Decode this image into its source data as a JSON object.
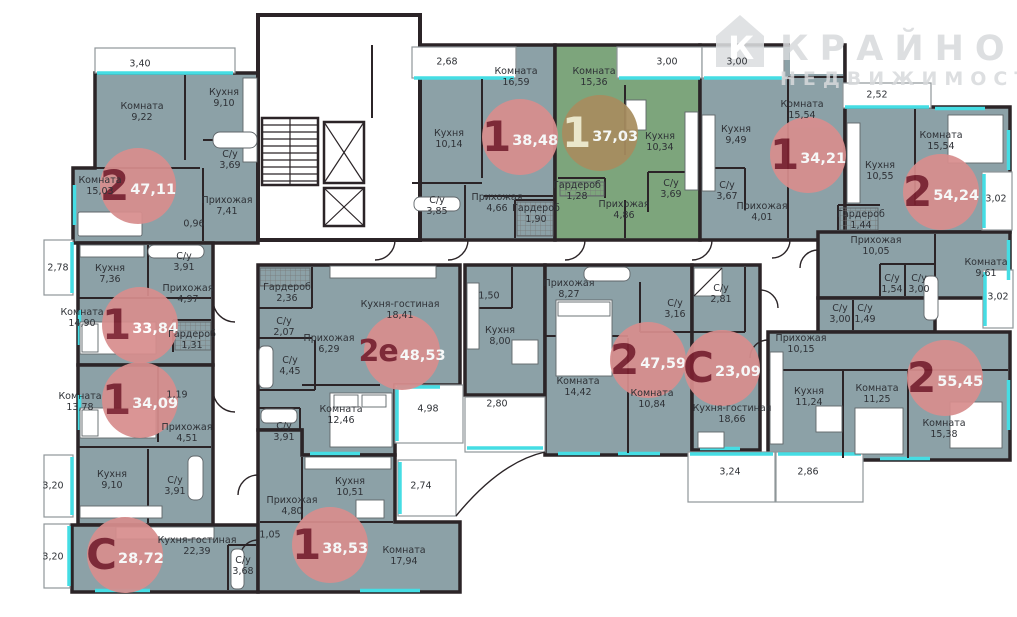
{
  "brand": {
    "line1": "КРАЙНОВ",
    "line2": "НЕДВИЖИМОСТЬ",
    "logo_letter": "К"
  },
  "palette": {
    "aptFill": "#8ca1a7",
    "aptHl": "#7da57c",
    "wall": "#2b2427",
    "accent": "#45dde4",
    "badge": "#d88e8e",
    "badgeType": "#7c2130",
    "badgeHl": "#a78d5f",
    "label": "#2e3136",
    "watermark": "#d8dadc"
  },
  "apartments": [
    {
      "type": "2",
      "area": "47,11",
      "x": 138,
      "y": 186,
      "highlight": false
    },
    {
      "type": "1",
      "area": "33,84",
      "x": 140,
      "y": 325,
      "highlight": false
    },
    {
      "type": "1",
      "area": "34,09",
      "x": 140,
      "y": 400,
      "highlight": false
    },
    {
      "type": "С",
      "area": "28,72",
      "x": 125,
      "y": 555,
      "highlight": false
    },
    {
      "type": "1",
      "area": "38,53",
      "x": 330,
      "y": 545,
      "highlight": false
    },
    {
      "type": "2е",
      "area": "48,53",
      "x": 402,
      "y": 352,
      "highlight": false
    },
    {
      "type": "1",
      "area": "38,48",
      "x": 520,
      "y": 137,
      "highlight": false
    },
    {
      "type": "1",
      "area": "37,03",
      "x": 600,
      "y": 133,
      "highlight": true
    },
    {
      "type": "1",
      "area": "34,21",
      "x": 808,
      "y": 155,
      "highlight": false
    },
    {
      "type": "2",
      "area": "54,24",
      "x": 941,
      "y": 192,
      "highlight": false
    },
    {
      "type": "2",
      "area": "47,59",
      "x": 648,
      "y": 360,
      "highlight": false
    },
    {
      "type": "С",
      "area": "23,09",
      "x": 722,
      "y": 368,
      "highlight": false
    },
    {
      "type": "2",
      "area": "55,45",
      "x": 945,
      "y": 378,
      "highlight": false
    }
  ],
  "rooms": [
    {
      "name": "",
      "area": "3,40",
      "x": 140,
      "y": 64
    },
    {
      "name": "Комната",
      "area": "9,22",
      "x": 142,
      "y": 112
    },
    {
      "name": "Кухня",
      "area": "9,10",
      "x": 224,
      "y": 98
    },
    {
      "name": "Комната",
      "area": "15,03",
      "x": 100,
      "y": 186
    },
    {
      "name": "С/у",
      "area": "3,69",
      "x": 230,
      "y": 160
    },
    {
      "name": "Прихожая",
      "area": "7,41",
      "x": 227,
      "y": 206
    },
    {
      "name": "",
      "area": "0,96",
      "x": 194,
      "y": 224
    },
    {
      "name": "",
      "area": "2,78",
      "x": 58,
      "y": 268
    },
    {
      "name": "Кухня",
      "area": "7,36",
      "x": 110,
      "y": 274
    },
    {
      "name": "С/у",
      "area": "3,91",
      "x": 184,
      "y": 262
    },
    {
      "name": "Прихожая",
      "area": "4,97",
      "x": 188,
      "y": 294
    },
    {
      "name": "Комната",
      "area": "14,90",
      "x": 82,
      "y": 318
    },
    {
      "name": "Гардероб",
      "area": "1,31",
      "x": 192,
      "y": 340
    },
    {
      "name": "Комната",
      "area": "13,78",
      "x": 80,
      "y": 402
    },
    {
      "name": "",
      "area": "1,19",
      "x": 177,
      "y": 395
    },
    {
      "name": "Прихожая",
      "area": "4,51",
      "x": 187,
      "y": 433
    },
    {
      "name": "Кухня",
      "area": "9,10",
      "x": 112,
      "y": 480
    },
    {
      "name": "С/у",
      "area": "3,91",
      "x": 175,
      "y": 486
    },
    {
      "name": "",
      "area": "3,20",
      "x": 53,
      "y": 486
    },
    {
      "name": "",
      "area": "3,20",
      "x": 53,
      "y": 557
    },
    {
      "name": "Кухня-гостиная",
      "area": "22,39",
      "x": 197,
      "y": 546
    },
    {
      "name": "С/у",
      "area": "3,68",
      "x": 243,
      "y": 566
    },
    {
      "name": "Прихожая",
      "area": "4,80",
      "x": 292,
      "y": 506
    },
    {
      "name": "",
      "area": "1,05",
      "x": 270,
      "y": 535
    },
    {
      "name": "Кухня",
      "area": "10,51",
      "x": 350,
      "y": 487
    },
    {
      "name": "",
      "area": "2,74",
      "x": 421,
      "y": 486
    },
    {
      "name": "Комната",
      "area": "17,94",
      "x": 404,
      "y": 556
    },
    {
      "name": "Гардероб",
      "area": "2,36",
      "x": 287,
      "y": 293
    },
    {
      "name": "С/у",
      "area": "2,07",
      "x": 284,
      "y": 327
    },
    {
      "name": "Прихожая",
      "area": "6,29",
      "x": 329,
      "y": 344
    },
    {
      "name": "С/у",
      "area": "4,45",
      "x": 290,
      "y": 366
    },
    {
      "name": "Кухня-гостиная",
      "area": "18,41",
      "x": 400,
      "y": 310
    },
    {
      "name": "Комната",
      "area": "12,46",
      "x": 341,
      "y": 415
    },
    {
      "name": "С/у",
      "area": "3,91",
      "x": 284,
      "y": 432
    },
    {
      "name": "",
      "area": "4,98",
      "x": 428,
      "y": 409
    },
    {
      "name": "",
      "area": "1,50",
      "x": 489,
      "y": 296
    },
    {
      "name": "Кухня",
      "area": "8,00",
      "x": 500,
      "y": 336
    },
    {
      "name": "",
      "area": "2,80",
      "x": 497,
      "y": 404
    },
    {
      "name": "",
      "area": "2,68",
      "x": 447,
      "y": 62
    },
    {
      "name": "Комната",
      "area": "16,59",
      "x": 516,
      "y": 77
    },
    {
      "name": "Кухня",
      "area": "10,14",
      "x": 449,
      "y": 139
    },
    {
      "name": "С/у",
      "area": "3,85",
      "x": 437,
      "y": 206
    },
    {
      "name": "Прихожая",
      "area": "4,66",
      "x": 497,
      "y": 203
    },
    {
      "name": "Гардероб",
      "area": "1,90",
      "x": 536,
      "y": 214
    },
    {
      "name": "Комната",
      "area": "15,36",
      "x": 594,
      "y": 77
    },
    {
      "name": "",
      "area": "3,00",
      "x": 667,
      "y": 62
    },
    {
      "name": "Кухня",
      "area": "10,34",
      "x": 660,
      "y": 142
    },
    {
      "name": "Гардероб",
      "area": "1,28",
      "x": 577,
      "y": 191
    },
    {
      "name": "С/у",
      "area": "3,69",
      "x": 671,
      "y": 189
    },
    {
      "name": "Прихожая",
      "area": "4,86",
      "x": 624,
      "y": 210
    },
    {
      "name": "",
      "area": "3,00",
      "x": 737,
      "y": 62
    },
    {
      "name": "Кухня",
      "area": "9,49",
      "x": 736,
      "y": 135
    },
    {
      "name": "С/у",
      "area": "3,67",
      "x": 727,
      "y": 191
    },
    {
      "name": "Прихожая",
      "area": "4,01",
      "x": 762,
      "y": 212
    },
    {
      "name": "Комната",
      "area": "15,54",
      "x": 802,
      "y": 110
    },
    {
      "name": "",
      "area": "2,52",
      "x": 877,
      "y": 95
    },
    {
      "name": "Кухня",
      "area": "10,55",
      "x": 880,
      "y": 171
    },
    {
      "name": "Гардероб",
      "area": "1,44",
      "x": 861,
      "y": 220
    },
    {
      "name": "Комната",
      "area": "15,54",
      "x": 941,
      "y": 141
    },
    {
      "name": "",
      "area": "3,02",
      "x": 996,
      "y": 199
    },
    {
      "name": "Прихожая",
      "area": "10,05",
      "x": 876,
      "y": 246
    },
    {
      "name": "С/у",
      "area": "1,54",
      "x": 892,
      "y": 284
    },
    {
      "name": "С/у",
      "area": "3,00",
      "x": 919,
      "y": 284
    },
    {
      "name": "Комната",
      "area": "9,61",
      "x": 986,
      "y": 268
    },
    {
      "name": "С/у",
      "area": "3,00",
      "x": 840,
      "y": 314
    },
    {
      "name": "С/у",
      "area": "1,49",
      "x": 865,
      "y": 314
    },
    {
      "name": "Прихожая",
      "area": "10,15",
      "x": 801,
      "y": 344
    },
    {
      "name": "Кухня",
      "area": "11,24",
      "x": 809,
      "y": 397
    },
    {
      "name": "Комната",
      "area": "11,25",
      "x": 877,
      "y": 394
    },
    {
      "name": "Комната",
      "area": "15,38",
      "x": 944,
      "y": 429
    },
    {
      "name": "",
      "area": "3,02",
      "x": 998,
      "y": 297
    },
    {
      "name": "",
      "area": "2,86",
      "x": 808,
      "y": 472
    },
    {
      "name": "Прихожая",
      "area": "8,27",
      "x": 569,
      "y": 289
    },
    {
      "name": "С/у",
      "area": "3,16",
      "x": 675,
      "y": 309
    },
    {
      "name": "Комната",
      "area": "14,42",
      "x": 578,
      "y": 387
    },
    {
      "name": "Комната",
      "area": "10,84",
      "x": 652,
      "y": 399
    },
    {
      "name": "С/у",
      "area": "2,81",
      "x": 721,
      "y": 294
    },
    {
      "name": "Кухня-гостиная",
      "area": "18,66",
      "x": 732,
      "y": 414
    },
    {
      "name": "",
      "area": "3,24",
      "x": 730,
      "y": 472
    }
  ]
}
